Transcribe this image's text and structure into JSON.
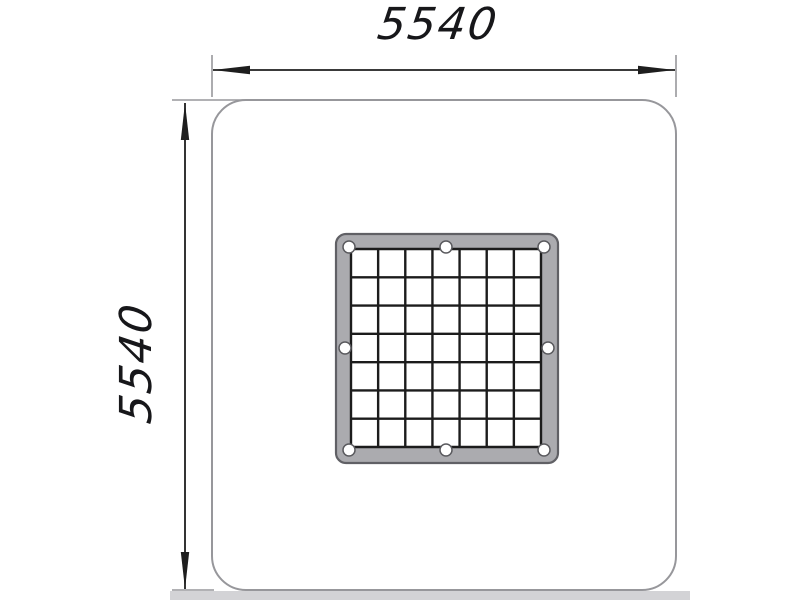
{
  "meta": {
    "description": "Technical plan-view drawing of a square safety mat with a central bolted grate, dimensioned 5540 by 5540"
  },
  "dimensions": {
    "top": {
      "value": "5540"
    },
    "left": {
      "value": "5540"
    }
  },
  "grate": {
    "rows": 7,
    "cols": 7,
    "bolt_hole_count": 8
  },
  "colors": {
    "outline_gray": "#97979b",
    "dimension_black": "#1e1e1e",
    "frame_fill": "#ababaf",
    "frame_stroke": "#606065",
    "grid_line": "#1c1c1c",
    "ground_band": "#d3d3d6",
    "text": "#17171a"
  }
}
